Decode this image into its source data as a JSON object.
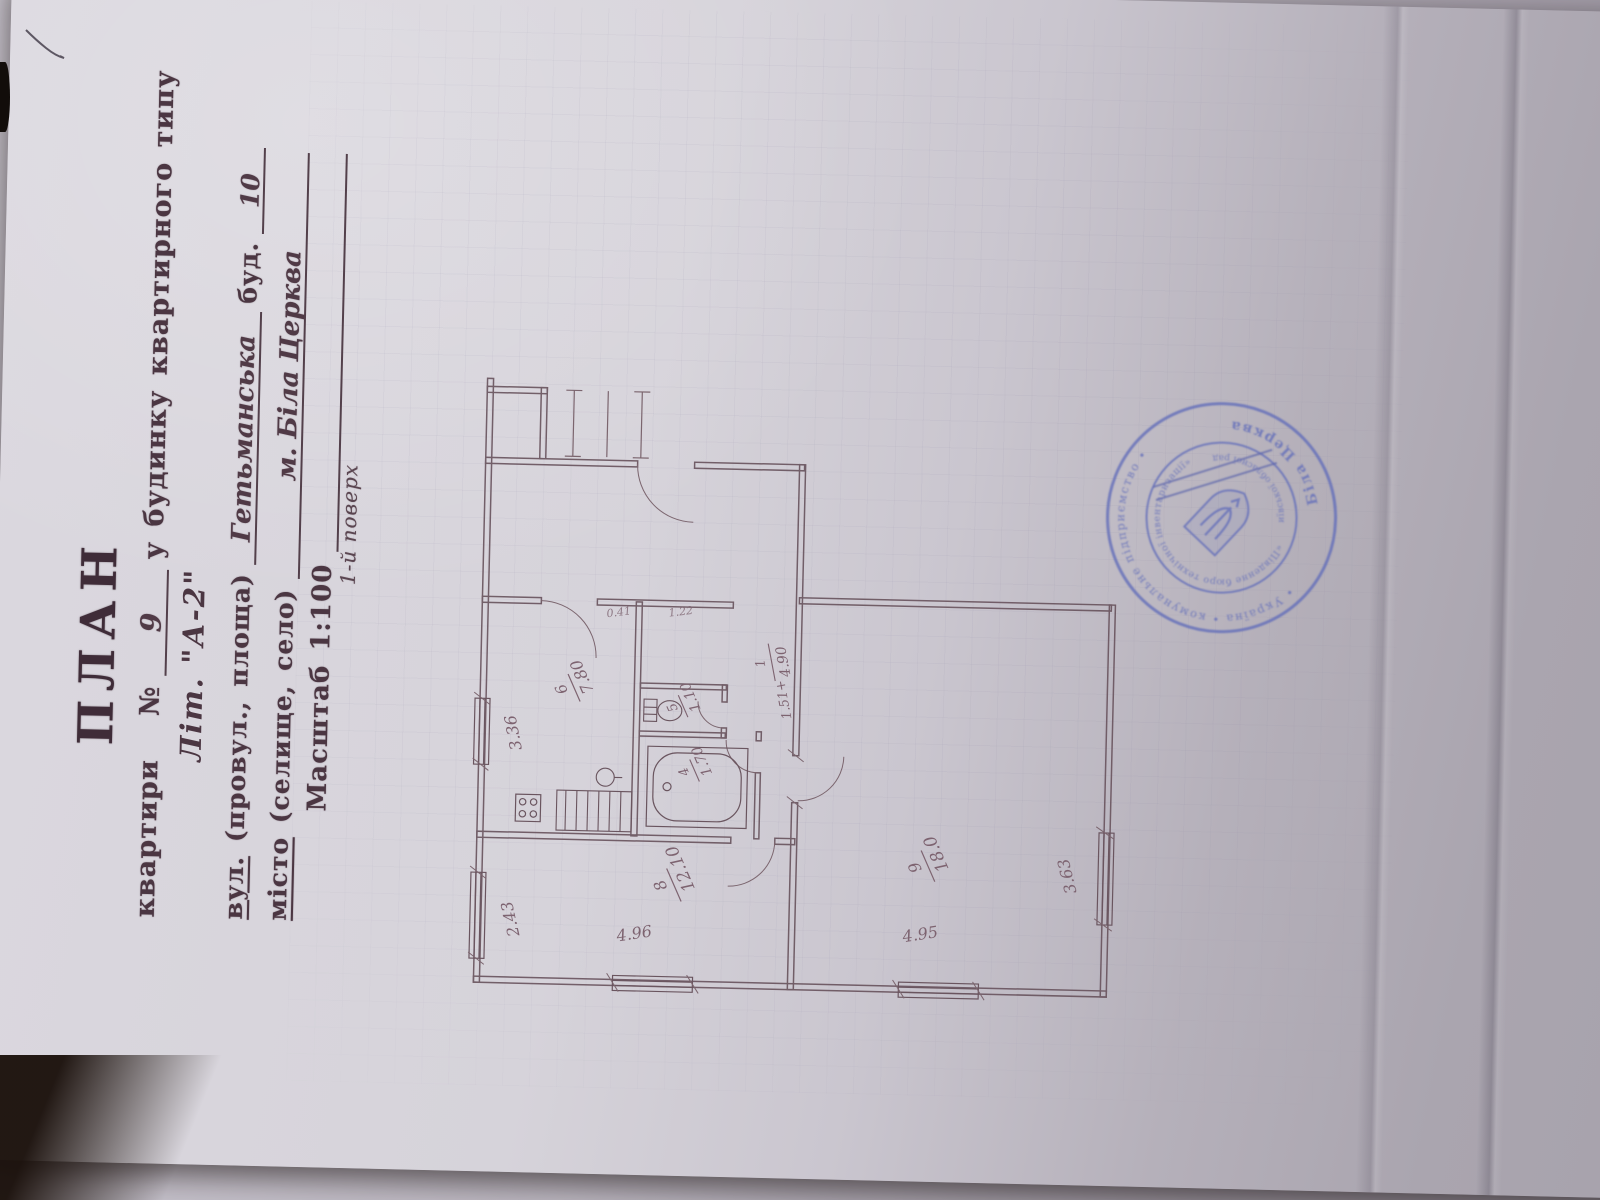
{
  "header": {
    "title": "ПЛАН",
    "line1": {
      "prefix": "квартири   №",
      "number": "9",
      "suffix": "у будинку квартирного типу"
    },
    "liter": "Літ. \"А-2\"",
    "street": {
      "label_u": "вул.",
      "label_rest": " (провул., площа)",
      "value": "Гетьманська",
      "bud_label": "буд.",
      "bud_value": "10"
    },
    "city": {
      "label_u": "місто",
      "label_rest": " (селище, село)",
      "value": "м. Біла Церква"
    },
    "scale": "Масштаб 1:100",
    "floor": "1-й поверх"
  },
  "plan": {
    "rooms": {
      "room8": {
        "number": "8",
        "area": "12.10"
      },
      "room9": {
        "number": "9",
        "area": "18.0"
      },
      "kitchen": {
        "number": "6",
        "area": "7.80"
      },
      "bath": {
        "number": "4",
        "area": "1.70"
      },
      "wc": {
        "number": "5",
        "area": "1.10"
      },
      "corridor": {
        "number": "1",
        "area_add": "1.51+",
        "area": "4.90"
      }
    },
    "dimensions": {
      "room8_top": "2.43",
      "kitchen_top": "3.36",
      "room8_side": "4.96",
      "room9_side": "4.95",
      "room9_bottom": "3.63",
      "door_a": "0.41",
      "door_b": "1.22"
    }
  },
  "stamp": {
    "outer_top": "• Україна • комунальне підприємство •",
    "outer_bottom": "Біла Церква",
    "inner_top": "«Південне бюро технічної інвентаризації»",
    "inner_bottom": "Київської обласної ради",
    "accent_color": "#6570ba"
  }
}
